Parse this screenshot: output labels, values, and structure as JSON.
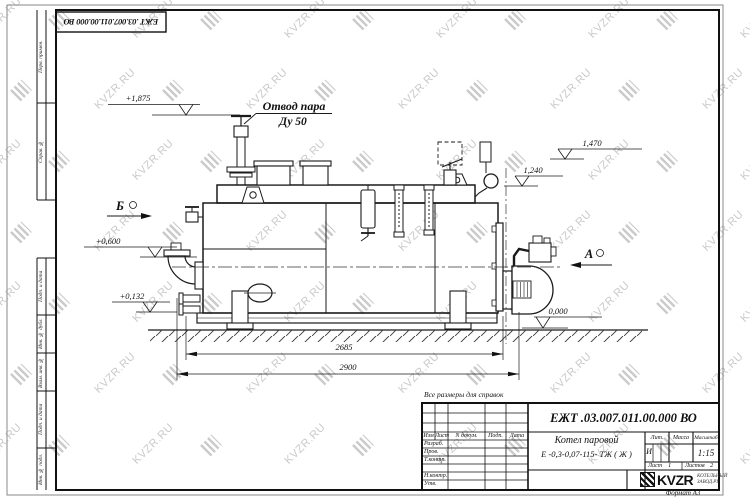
{
  "page": {
    "watermark_text": "KVZR.RU",
    "format_note": "Формат А3",
    "reference_note": "Все размеры для справок"
  },
  "corner_stamp": {
    "doc_number": "ЕЖТ .03.007.011.00.000  ВО"
  },
  "margin": {
    "top_labels": [
      "Перв. примен.",
      "Справ. №"
    ],
    "bottom_labels": [
      "Подп. и дата",
      "Инв. № дубл.",
      "Взам. инв. №",
      "Подп. и дата",
      "Инв. № подл."
    ]
  },
  "drawing": {
    "callout": {
      "line1": "Отвод пара",
      "line2": "Ду 50"
    },
    "views": {
      "b": "Б",
      "a": "А"
    },
    "elevations": [
      "+1,875",
      "1,470",
      "1,240",
      "+0,600",
      "+0,132",
      "0,000"
    ],
    "dimensions": [
      "2685",
      "2900"
    ]
  },
  "title_block": {
    "doc_number": "ЕЖТ .03.007.011.00.000  ВО",
    "product_line1": "Котел паровой",
    "product_line2": "Е -0,3-0,07-115- ТЖ ( Ж )",
    "header_cols": [
      "Изм",
      "Лист",
      "N докум.",
      "Подп.",
      "Дата"
    ],
    "role_rows": [
      "Разраб.",
      "Пров.",
      "Т.контр.",
      "Н.контр.",
      "Утв."
    ],
    "lit_label": "Лит.",
    "mass_label": "Масса",
    "scale_label": "Масштаб",
    "lit_value": "И",
    "scale_value": "1:15",
    "sheet_label": "Лист",
    "sheet_number": "1",
    "sheets_label": "Листов",
    "sheets_total": "2",
    "brand": "KVZR",
    "brand_sub1": "КОТЕЛЬНЫЙ",
    "brand_sub2": "ЗАВОД.РУ"
  }
}
